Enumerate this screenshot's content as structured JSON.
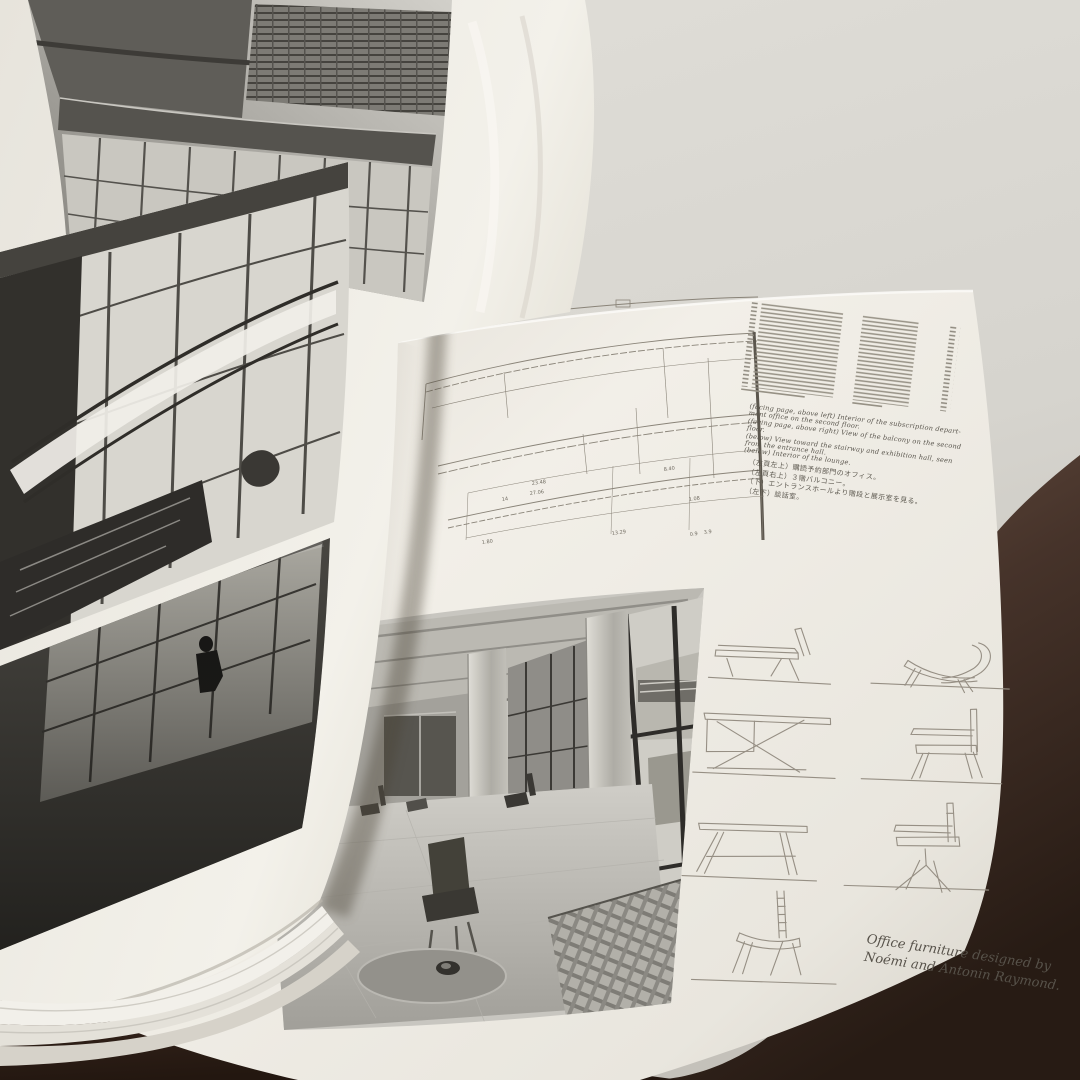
{
  "colors": {
    "table_dark": "#2e211a",
    "table_light": "#5d4639",
    "wall": "#dcdad4",
    "page": "#efece4",
    "ink": "#59554d",
    "drawing_line": "#8a8479"
  },
  "right_page": {
    "plan": {
      "dimensions": [
        "23.48",
        "27.06",
        "14",
        "13.29",
        "1.80",
        "8.40",
        "1.08",
        "0.9",
        "3.9"
      ]
    },
    "caption_en": {
      "lines": [
        "(facing page, above left) Interior of the subscription depart-",
        "ment office on the second floor.",
        "(facing page, above right) View of the balcony on the second",
        "floor.",
        "(below) View toward the stairway and exhibition hall, seen",
        "from the entrance hall.",
        "(below) Interior of the lounge."
      ]
    },
    "caption_jp": {
      "lines": [
        "（左頁左上）購読予約部門のオフィス。",
        "（左頁右上）３階バルコニー。",
        "（下）エントランスホールより階段と展示室を見る。",
        "（左下）談話室。"
      ]
    },
    "furniture_caption": {
      "line1": "Office furniture designed by",
      "line2": "Noémi and Antonin Raymond."
    }
  }
}
